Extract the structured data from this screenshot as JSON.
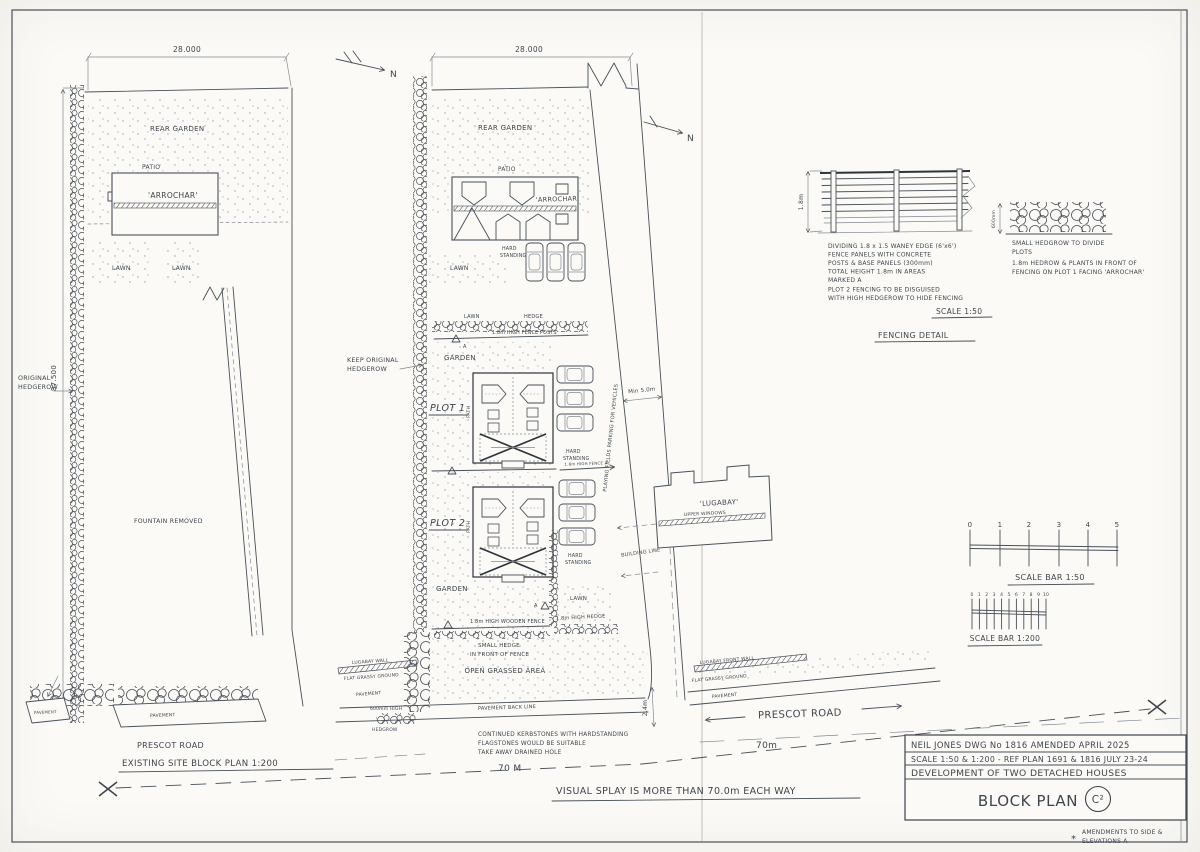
{
  "sheet": {
    "existing_plan": {
      "dim_width": "28.000",
      "dim_height": "87.500",
      "hedgerow_label": [
        "ORIGINAL",
        "HEDGEROW"
      ],
      "rear_garden": "REAR GARDEN",
      "patio": "PATIO",
      "house": "'ARROCHAR'",
      "lawn1": "LAWN",
      "lawn2": "LAWN",
      "fountain": "FOUNTAIN REMOVED",
      "pavement1": "PAVEMENT",
      "pavement2": "PAVEMENT",
      "road": "PRESCOT ROAD",
      "caption": "EXISTING SITE BLOCK PLAN 1:200"
    },
    "proposed_plan": {
      "dim_width": "28.000",
      "north1": "N",
      "north2": "N",
      "rear_garden": "REAR GARDEN",
      "patio": "PATIO",
      "house": "'ARROCHAR'",
      "lawn_top": "LAWN",
      "hs_top": [
        "HARD",
        "STANDING"
      ],
      "keep_hedgerow": [
        "KEEP ORIGINAL",
        "HEDGEROW"
      ],
      "lawn_strip": "LAWN",
      "hedge_strip": "HEDGE",
      "fence_posts": "1.8m HIGH FENCE POSTS",
      "garden1": "GARDEN",
      "plot1": "PLOT 1",
      "path1": "PATH",
      "hs1": [
        "HARD",
        "STANDING"
      ],
      "divider_note": "1.8m HIGH FENCE A",
      "mark_a1": "A",
      "mark_a2": "A",
      "plot2": "PLOT 2",
      "path2": "PATH",
      "hs2": [
        "HARD",
        "STANDING"
      ],
      "garden2": "GARDEN",
      "lawn2": "LAWN",
      "wooden_fence": "1.8m HIGH WOODEN FENCE",
      "high_hedge": "1.8m HIGH HEDGE",
      "small_hedge": [
        "SMALL HEDGE",
        "IN FRONT OF FENCE"
      ],
      "open_grassed": "OPEN GRASSED AREA",
      "drive_note": "PLAYING FIELDS PARKING FOR VEHICLES",
      "min5": "Min 5.0m",
      "building_line": "BUILDING LINE",
      "lugabay": "'LUGABAY'",
      "upper_windows": "UPPER WINDOWS",
      "lugabay_wall": "LUGABAY WALL",
      "flat_grassy1": "FLAT GRASSY GROUND",
      "pavement1": "PAVEMENT",
      "hedge600": [
        "600mm HIGH",
        "HEDGROW"
      ],
      "pavement2": "PAVEMENT",
      "pavement_line": "PAVEMENT  BACK LINE",
      "kerb_note": [
        "CONTINUED KERBSTONES WITH HARDSTANDING",
        "FLAGSTONES WOULD BE SUITABLE",
        "TAKE AWAY DRAINED HOLE"
      ],
      "dim24": "2.4m",
      "dim70l": "70 M",
      "lugabay_front_wall": "LUGABAY FRONT WALL",
      "flat_grassy2": "FLAT GRASSY GROUND",
      "pavement3": "PAVEMENT",
      "road": "PRESCOT ROAD",
      "dim70r": "70m",
      "splay": "VISUAL SPLAY IS MORE THAN 70.0m EACH WAY"
    },
    "fencing_detail": {
      "dim18": "1.8m",
      "notes": [
        "DIVIDING 1.8 x 1.5 WANEY EDGE (6'x6')",
        "FENCE PANELS WITH CONCRETE",
        "POSTS & BASE PANELS (300mm)",
        "TOTAL HEIGHT 1.8m IN AREAS",
        "MARKED A",
        "PLOT 2 FENCING TO BE DISGUISED",
        "WITH HIGH HEDGEROW TO HIDE FENCING"
      ],
      "scale": "SCALE 1:50",
      "caption": "FENCING DETAIL",
      "dim600": "600mm",
      "hedge_notes": [
        "SMALL HEDGROW TO DIVIDE",
        "PLOTS",
        "1.8m HEDROW & PLANTS IN FRONT OF",
        "FENCING ON PLOT 1 FACING 'ARROCHAR'"
      ]
    },
    "scale_bars": {
      "bar50_ticks": [
        "0",
        "1",
        "2",
        "3",
        "4",
        "5"
      ],
      "bar50_label": "SCALE BAR 1:50",
      "bar200_ticks": [
        "0",
        "1",
        "2",
        "3",
        "4",
        "5",
        "6",
        "7",
        "8",
        "9",
        "10"
      ],
      "bar200_label": "SCALE BAR 1:200"
    },
    "title_block": {
      "row1": "NEIL JONES   DWG No 1816   AMENDED  APRIL  2025",
      "row2": "SCALE 1:50 & 1:200 - REF PLAN 1691 & 1816  JULY 23-24",
      "row3": "DEVELOPMENT OF TWO DETACHED HOUSES",
      "title": "BLOCK PLAN",
      "rev": "C²",
      "star": "*",
      "amendment": [
        "AMENDMENTS TO SIDE &",
        "ELEVATIONS  A"
      ]
    }
  }
}
